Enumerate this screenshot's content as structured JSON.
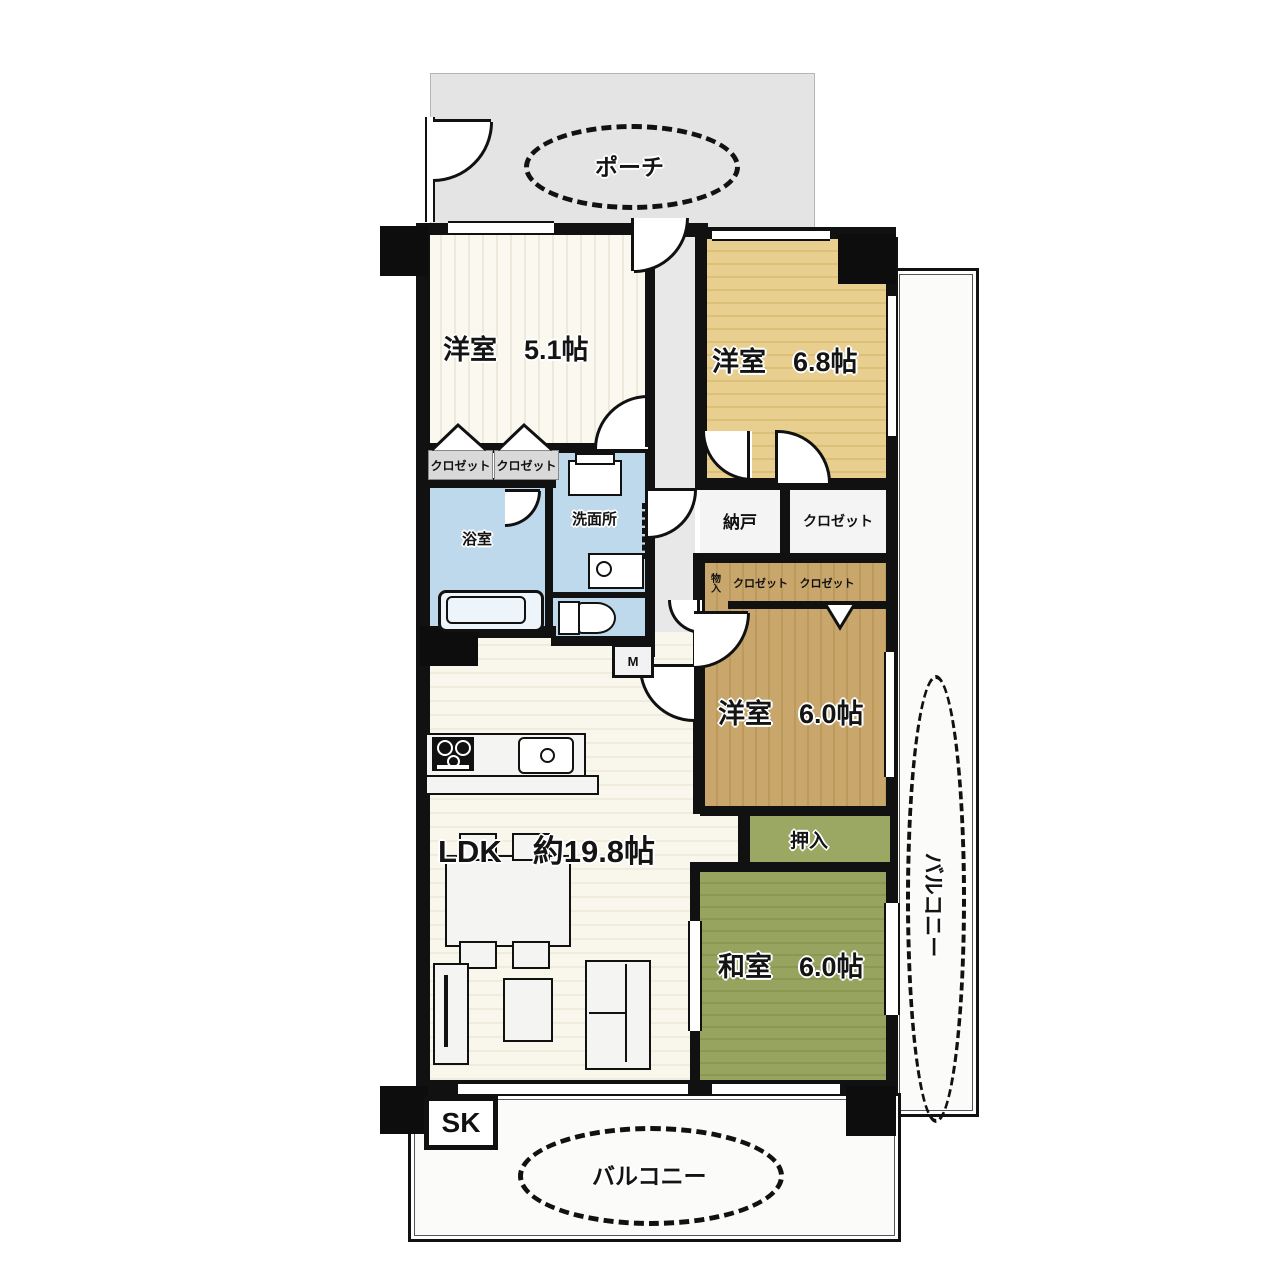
{
  "plan_title": "マンション間取り図",
  "labels": {
    "porch": "ポーチ",
    "room_5_1": "洋室　5.1帖",
    "room_6_8": "洋室　6.8帖",
    "room_6_0": "洋室　6.0帖",
    "washitsu": "和室　6.0帖",
    "ldk": "LDK　約19.8帖",
    "bathroom": "浴室",
    "washroom": "洗面所",
    "nando": "納戸",
    "closet_1": "クロゼット",
    "closet_2": "クロゼット",
    "closet_3": "クロゼット",
    "closet_4": "クロゼット",
    "closet_5": "クロゼット",
    "monoire": "物入",
    "oshiire": "押入",
    "balcony_right": "バルコニー",
    "balcony_bottom": "バルコニー",
    "sk": "SK",
    "meter": "M"
  },
  "colors": {
    "wall": "#111111",
    "porch_bg": "#e4e4e4",
    "hall_bg": "#e8e8e8",
    "cream_floor": "#f9f6ec",
    "tan_floor": "#e8cd8c",
    "brown_floor": "#c7a56a",
    "tatami_green": "#94a25d",
    "oshiire_green": "#9aa863",
    "water_blue": "#bed9eb",
    "balcony_bg": "#fbfbfa",
    "storage_bg": "#f4f4f4"
  }
}
